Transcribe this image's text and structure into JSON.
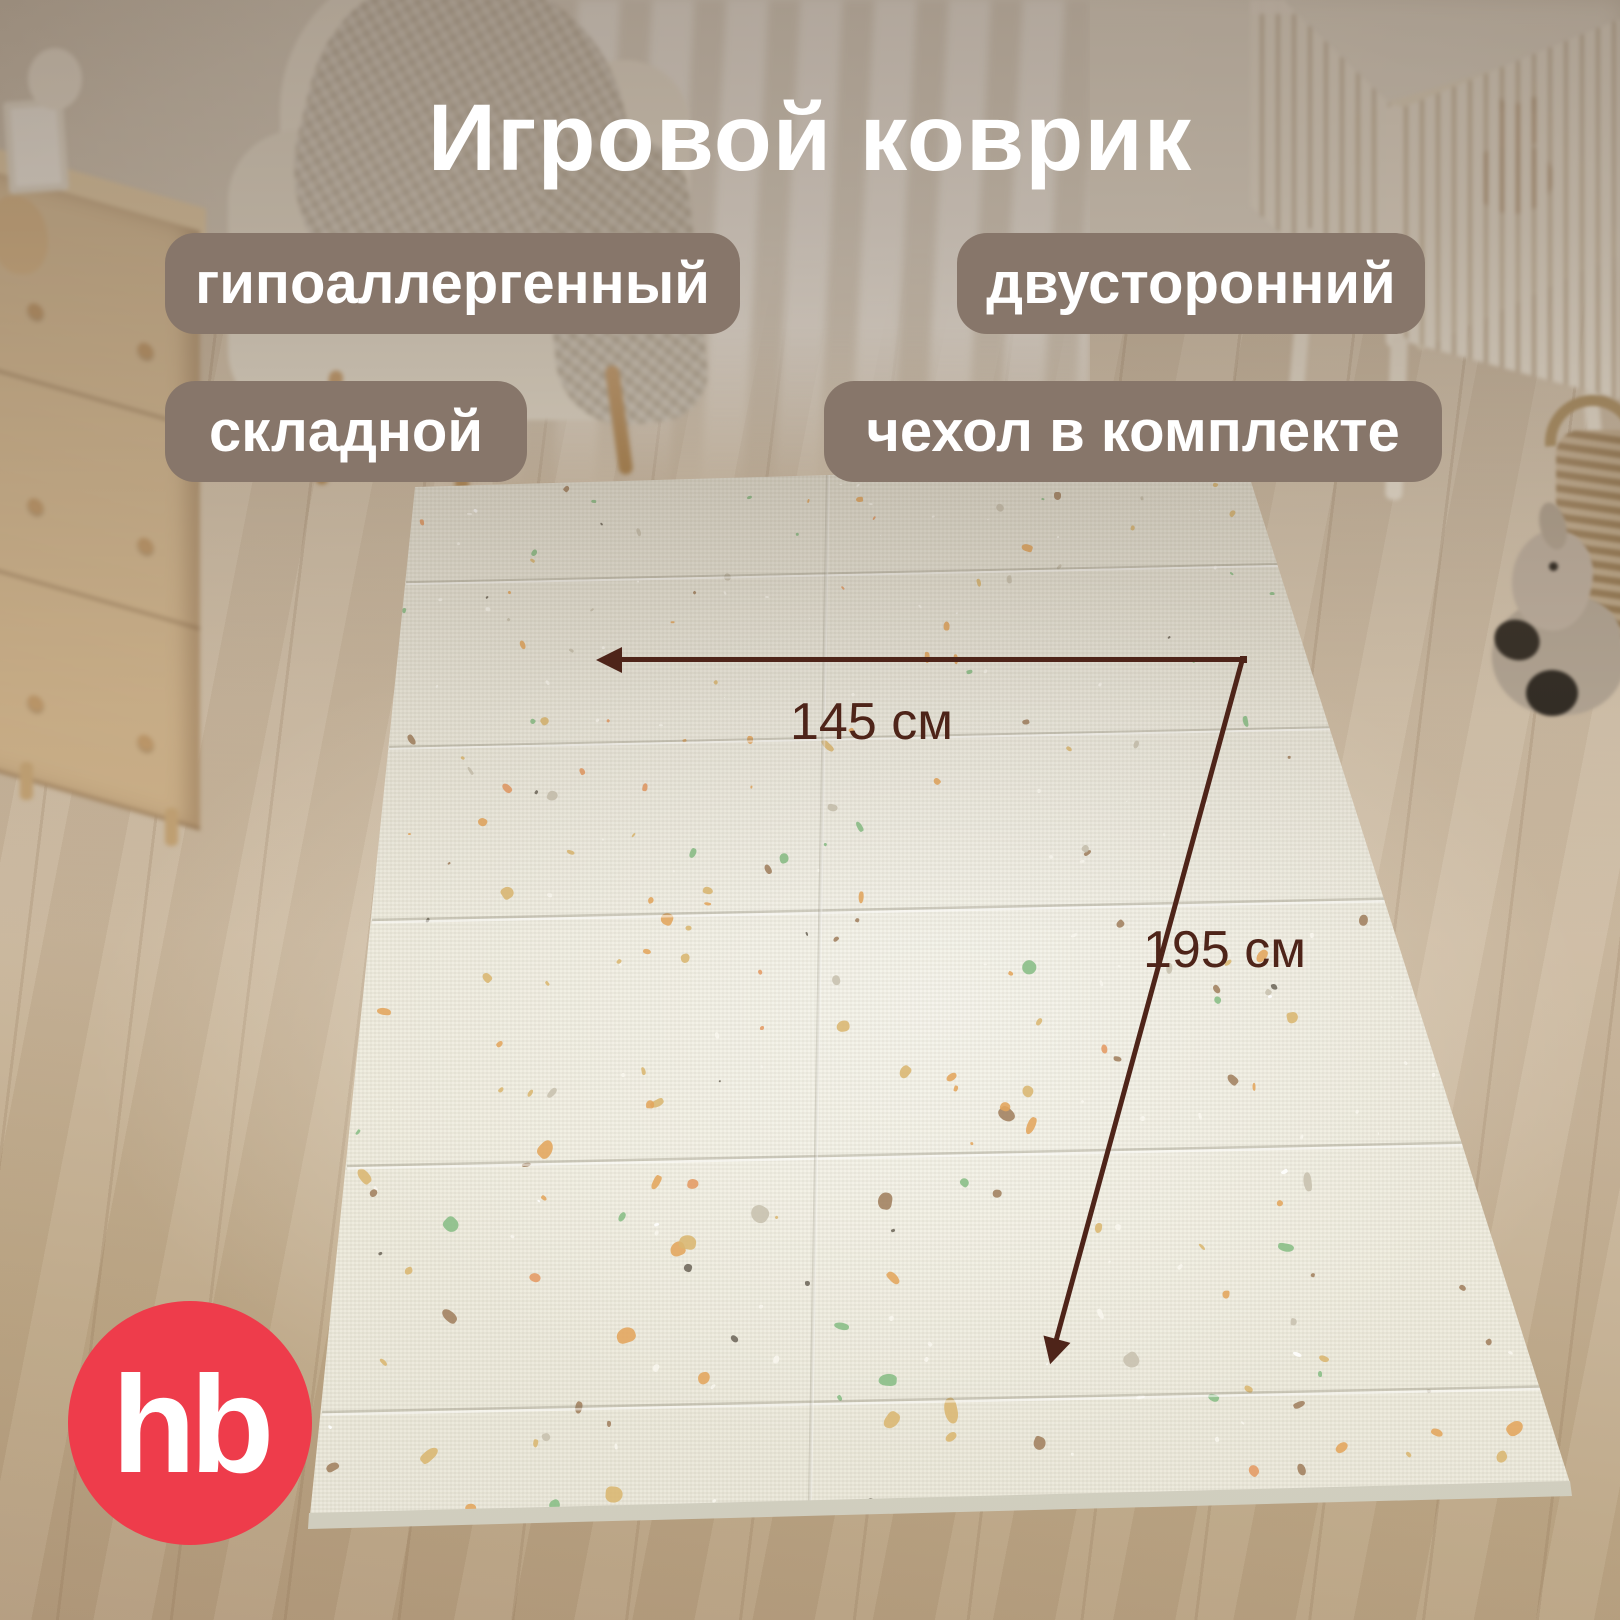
{
  "title": "Игровой коврик",
  "badges": [
    {
      "id": "hypoallergenic",
      "label": "гипоаллергенный"
    },
    {
      "id": "double-sided",
      "label": "двусторонний"
    },
    {
      "id": "foldable",
      "label": "складной"
    },
    {
      "id": "cover-included",
      "label": "чехол в комплекте"
    }
  ],
  "dimensions": {
    "width_label": "145 см",
    "length_label": "195 см"
  },
  "logo": {
    "text": "hb"
  },
  "colors": {
    "badge_bg": "#87766a",
    "dim_color": "#4e2419",
    "text_color": "#ffffff",
    "logo_bg": "#ee3c4b"
  }
}
